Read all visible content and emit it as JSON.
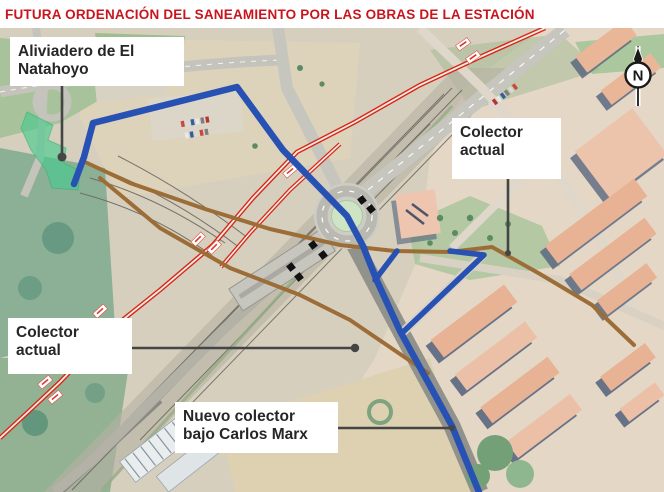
{
  "title": "FUTURA ORDENACIÓN DEL SANEAMIENTO POR LAS OBRAS DE LA ESTACIÓN",
  "labels": {
    "aliviadero": {
      "line1": "Aliviadero de El",
      "line2": "Natahoyo"
    },
    "colector_actual_right": {
      "line1": "Colector",
      "line2": "actual"
    },
    "colector_actual_left": {
      "line1": "Colector",
      "line2": "actual"
    },
    "nuevo_colector": {
      "line1": "Nuevo colector",
      "line2": "bajo Carlos Marx"
    }
  },
  "compass": {
    "label": "N"
  },
  "colors": {
    "title_red": "#c9151d",
    "new_collector_blue": "#2851b4",
    "existing_collector_brown": "#9c6d36",
    "railway_red": "#d92619",
    "aliviadero_green": "#43c98c",
    "leader_gray": "#454545",
    "works_marker_black": "#121212",
    "label_text": "#262626",
    "label_background": "#ffffff"
  }
}
